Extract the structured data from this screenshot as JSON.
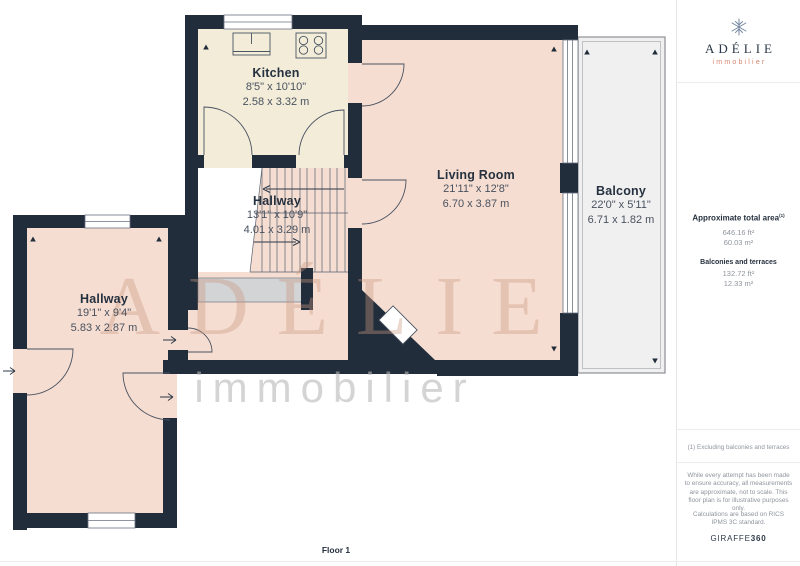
{
  "colors": {
    "wall": "#212d3b",
    "kitchen_floor": "#f2ecd9",
    "room_floor": "#f6ddd1",
    "balcony_floor": "#f0f0f1",
    "under_stairs_slab": "#d2d4d6",
    "accent_coral": "#d98570",
    "brand_navy": "#2c3847",
    "muted_text": "#8f949d"
  },
  "plan": {
    "floor_label": "Floor 1",
    "watermark": {
      "brand": "ADÉLIE",
      "tagline": "immobilier"
    },
    "rooms": [
      {
        "name": "Kitchen",
        "imperial": "8'5\" x 10'10\"",
        "metric": "2.58 x 3.32 m"
      },
      {
        "name": "Hallway",
        "imperial": "13'1\" x 10'9\"",
        "metric": "4.01 x 3.29 m"
      },
      {
        "name": "Living Room",
        "imperial": "21'11\" x 12'8\"",
        "metric": "6.70 x 3.87 m"
      },
      {
        "name": "Balcony",
        "imperial": "22'0\" x 5'11\"",
        "metric": "6.71 x 1.82 m"
      },
      {
        "name": "Hallway",
        "imperial": "19'1\" x 9'4\"",
        "metric": "5.83 x 2.87 m"
      }
    ]
  },
  "sidebar": {
    "brand": {
      "name": "ADÉLIE",
      "tagline": "immobilier",
      "icon": "snowflake-icon"
    },
    "total_area": {
      "heading": "Approximate total area",
      "footnote_marker": "(1)",
      "imperial": "646.16 ft²",
      "metric": "60.03 m²"
    },
    "balconies_area": {
      "heading": "Balconies and terraces",
      "imperial": "132.72 ft²",
      "metric": "12.33 m²"
    },
    "footnote": "(1) Excluding balconies and terraces",
    "disclaimer": "While every attempt has been made to ensure accuracy, all measurements are approximate, not to scale. This floor plan is for illustrative purposes only.",
    "standard_note": "Calculations are based on RICS IPMS 3C standard.",
    "provider": {
      "name": "GIRAFFE",
      "suffix": "360"
    }
  }
}
